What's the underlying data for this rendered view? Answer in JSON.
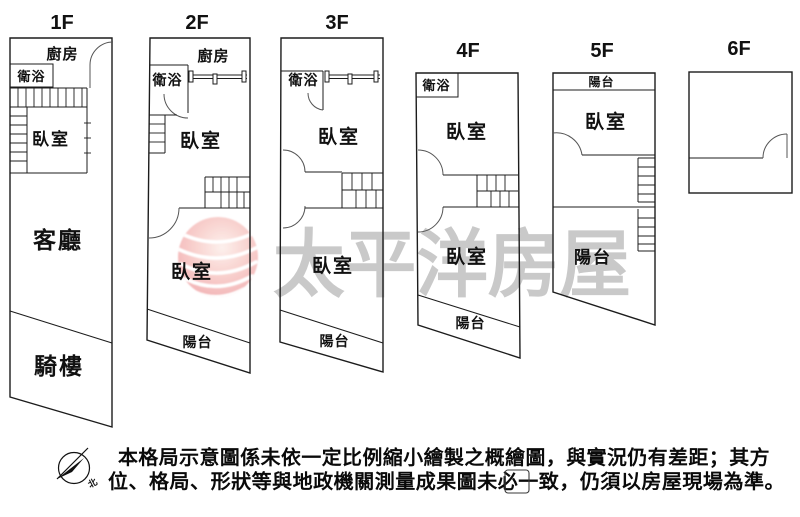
{
  "colors": {
    "background": "#ffffff",
    "line": "#1c1c1c",
    "watermark_text": "#c9c9c9",
    "logo_pink": "#f0999c",
    "disclaimer_text": "#0a0a0a"
  },
  "floors": [
    {
      "title": "1F",
      "rooms": {
        "kitchen": "廚房",
        "bathroom": "衛浴",
        "bedroom": "臥室",
        "living_room": "客廳",
        "arcade": "騎樓"
      }
    },
    {
      "title": "2F",
      "rooms": {
        "kitchen": "廚房",
        "bathroom": "衛浴",
        "bedroom_upper": "臥室",
        "bedroom_lower": "臥室",
        "balcony": "陽台"
      }
    },
    {
      "title": "3F",
      "rooms": {
        "bathroom": "衛浴",
        "bedroom_upper": "臥室",
        "bedroom_lower": "臥室",
        "balcony": "陽台"
      }
    },
    {
      "title": "4F",
      "rooms": {
        "bathroom": "衛浴",
        "bedroom_upper": "臥室",
        "bedroom_lower": "臥室",
        "balcony": "陽台"
      }
    },
    {
      "title": "5F",
      "rooms": {
        "balcony_top": "陽台",
        "bedroom": "臥室",
        "balcony_bottom": "陽台"
      }
    },
    {
      "title": "6F",
      "rooms": {}
    }
  ],
  "watermark": {
    "brand_text": "太平洋房屋"
  },
  "compass": {
    "north_label": "北"
  },
  "disclaimer": {
    "line1": "本格局示意圖係未依一定比例縮小繪製之概繪圖，與實況仍有差距；其方",
    "line2": "位、格局、形狀等與地政機關測量成果圖未必一致，仍須以房屋現場為準。"
  }
}
